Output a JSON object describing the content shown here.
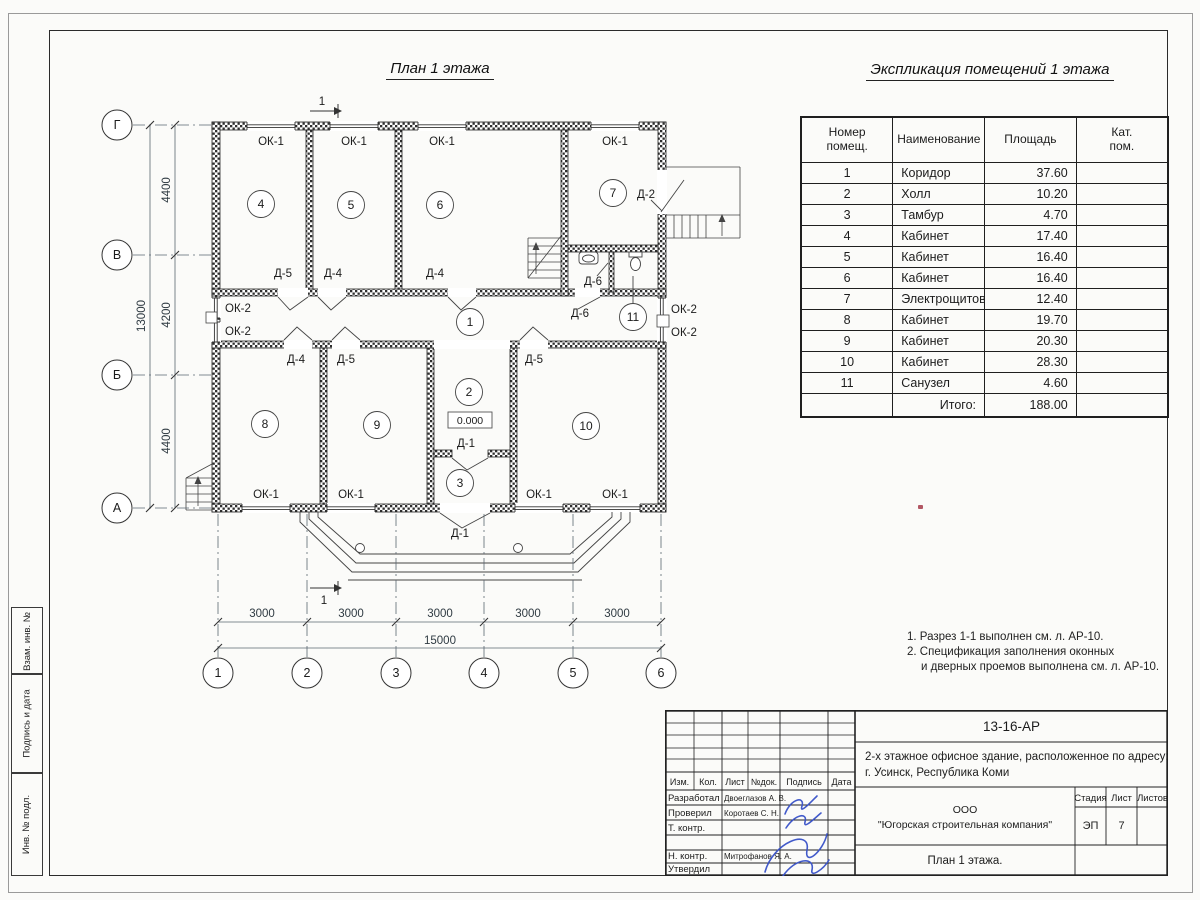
{
  "titles": {
    "plan": "План 1 этажа",
    "explication": "Экспликация помещений 1 этажа"
  },
  "notes": {
    "line1": "1. Разрез 1-1 выполнен см. л. АР-10.",
    "line2": "2. Спецификация заполнения оконных",
    "line3": "и дверных проемов выполнена см. л. АР-10."
  },
  "table": {
    "h_number1": "Номер",
    "h_number2": "помещ.",
    "h_name": "Наименование",
    "h_area": "Площадь",
    "h_cat1": "Кат.",
    "h_cat2": "пом.",
    "rows": [
      {
        "n": "1",
        "name": "Коридор",
        "area": "37.60",
        "cat": ""
      },
      {
        "n": "2",
        "name": "Холл",
        "area": "10.20",
        "cat": ""
      },
      {
        "n": "3",
        "name": "Тамбур",
        "area": "4.70",
        "cat": ""
      },
      {
        "n": "4",
        "name": "Кабинет",
        "area": "17.40",
        "cat": ""
      },
      {
        "n": "5",
        "name": "Кабинет",
        "area": "16.40",
        "cat": ""
      },
      {
        "n": "6",
        "name": "Кабинет",
        "area": "16.40",
        "cat": ""
      },
      {
        "n": "7",
        "name": "Электрощитовая, котельная",
        "area": "12.40",
        "cat": ""
      },
      {
        "n": "8",
        "name": "Кабинет",
        "area": "19.70",
        "cat": ""
      },
      {
        "n": "9",
        "name": "Кабинет",
        "area": "20.30",
        "cat": ""
      },
      {
        "n": "10",
        "name": "Кабинет",
        "area": "28.30",
        "cat": ""
      },
      {
        "n": "11",
        "name": "Санузел",
        "area": "4.60",
        "cat": ""
      }
    ],
    "total_label": "Итого:",
    "total_value": "188.00"
  },
  "plan": {
    "axes_h": [
      "1",
      "2",
      "3",
      "4",
      "5",
      "6"
    ],
    "axes_v": [
      "Г",
      "В",
      "Б",
      "А"
    ],
    "dims_left": [
      "4400",
      "4200",
      "4400"
    ],
    "dim_left_total": "13000",
    "dims_bottom": [
      "3000",
      "3000",
      "3000",
      "3000",
      "3000"
    ],
    "dim_bottom_total": "15000",
    "rooms": [
      "1",
      "2",
      "3",
      "4",
      "5",
      "6",
      "7",
      "8",
      "9",
      "10",
      "11"
    ],
    "level_mark": "0.000",
    "section_label": "1",
    "ok1": "ОК-1",
    "ok2": "ОК-2",
    "d1": "Д-1",
    "d2": "Д-2",
    "d4": "Д-4",
    "d5": "Д-5",
    "d6": "Д-6"
  },
  "title_block": {
    "doc_number": "13-16-АР",
    "project_line1": "2-х этажное офисное здание, расположенное по адресу:",
    "project_line2": "г. Усинск, Республика Коми",
    "company_line1": "ООО",
    "company_line2": "\"Югорская строительная компания\"",
    "drawing_title": "План 1 этажа.",
    "col_izm": "Изм.",
    "col_kol": "Кол.",
    "col_list": "Лист",
    "col_doc": "№док.",
    "col_sign": "Подпись",
    "col_date": "Дата",
    "role_developed": "Разработал",
    "name_developed": "Двоеглазов А. В.",
    "role_checked": "Проверил",
    "name_checked": "Коротаев С. Н.",
    "role_tcontrol": "Т. контр.",
    "role_ncontrol": "Н. контр.",
    "name_ncontrol": "Митрофанов Я. А.",
    "role_approved": "Утвердил",
    "stage_label": "Стадия",
    "sheet_label": "Лист",
    "sheets_label": "Листов",
    "stage_value": "ЭП",
    "sheet_value": "7"
  },
  "side_strip": {
    "box1": "Взам. инв. №",
    "box2": "Подпись и дата",
    "box3": "Инв. № подл."
  }
}
